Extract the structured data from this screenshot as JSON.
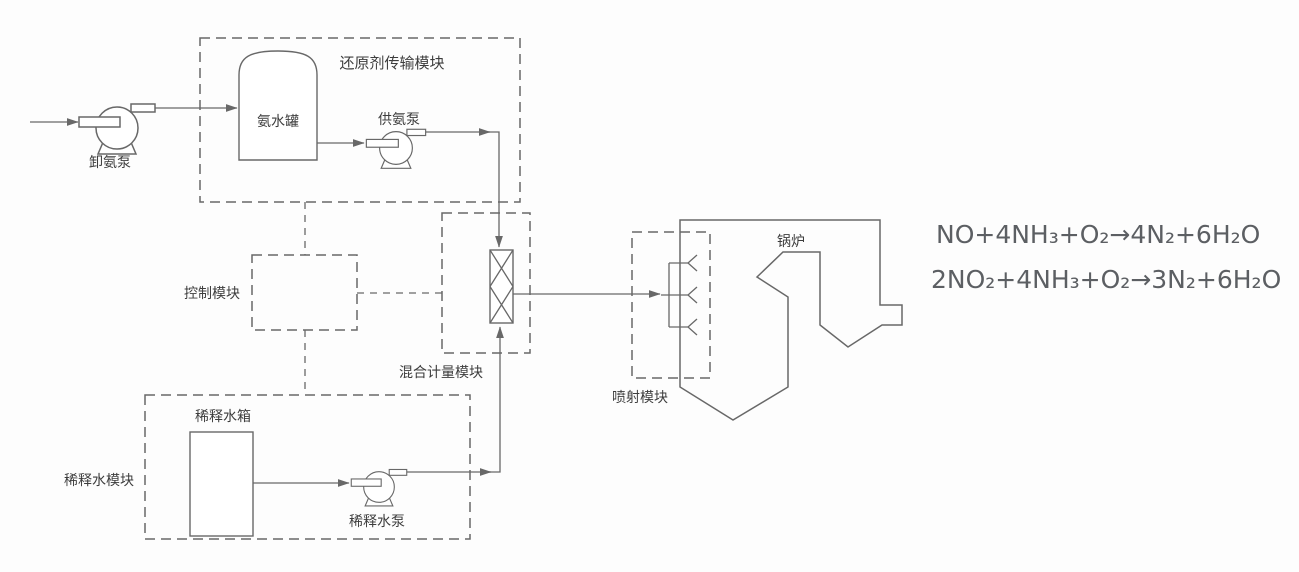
{
  "diagram_title": "SCR脱硝系统流程图",
  "modules": {
    "reductant_transport": {
      "label": "还原剂传输模块"
    },
    "control": {
      "label": "控制模块"
    },
    "mixing_metering": {
      "label": "混合计量模块"
    },
    "dilution_water": {
      "label": "稀释水模块"
    },
    "injection": {
      "label": "喷射模块"
    }
  },
  "equipment": {
    "unloading_pump": {
      "label": "卸氨泵"
    },
    "ammonia_tank": {
      "label": "氨水罐"
    },
    "supply_pump": {
      "label": "供氨泵"
    },
    "dilution_tank": {
      "label": "稀释水箱"
    },
    "dilution_pump": {
      "label": "稀释水泵"
    },
    "boiler": {
      "label": "锅炉"
    }
  },
  "equations": {
    "line1": "NO+4NH₃+O₂→4N₂+6H₂O",
    "line2": "2NO₂+4NH₃+O₂→3N₂+6H₂O"
  },
  "colors": {
    "line": "#686868",
    "label_text": "#3d3d3d",
    "equation_text": "#5c5f63",
    "background": "#fdfdfd"
  }
}
